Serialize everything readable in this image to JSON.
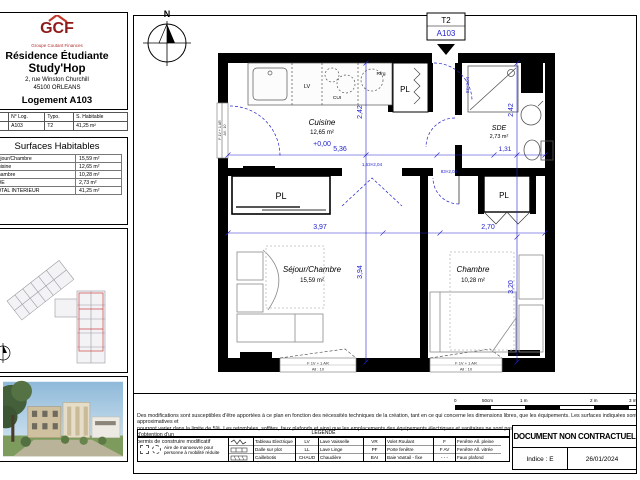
{
  "sheet": {
    "header": {
      "logo_acronym": "GCF",
      "logo_subtitle": "Groupe Coutant Finances",
      "title_line1": "Résidence Étudiante",
      "title_line2": "Study'Hop",
      "address_line1": "2, rue Winston Churchill",
      "address_line2": "45100 ORLEANS",
      "lot_title": "Logement A103"
    },
    "info_table": {
      "headers": [
        "Niv.",
        "N° Log.",
        "Typo.",
        "S. Habitable"
      ],
      "row": [
        "1",
        "A103",
        "T2",
        "41,25 m²"
      ]
    },
    "surfaces": {
      "title": "Surfaces Habitables",
      "rows": [
        {
          "label": "Séjour/Chambre",
          "value": "15,59 m²"
        },
        {
          "label": "Cuisine",
          "value": "12,65 m²"
        },
        {
          "label": "Chambre",
          "value": "10,28 m²"
        },
        {
          "label": "SDE",
          "value": "2,73 m²"
        },
        {
          "label": "TOTAL INTERIEUR",
          "value": "41,25 m²"
        }
      ]
    }
  },
  "plan": {
    "north_label": "N",
    "unit_tag": {
      "type": "T2",
      "number": "A103"
    },
    "rooms": {
      "cuisine": {
        "name": "Cuisine",
        "area": "12,65 m²",
        "level": "+0,00"
      },
      "sde": {
        "name": "SDE",
        "area": "2,73 m²"
      },
      "sejour": {
        "name": "Séjour/Chambre",
        "area": "15,59 m²"
      },
      "chambre": {
        "name": "Chambre",
        "area": "10,28 m²"
      }
    },
    "closet_label": "PL",
    "appliances": {
      "lv": "LV",
      "cui": "CUI",
      "rfrg": "Rfrg"
    },
    "dims": {
      "cuisine_w": "5,36",
      "cuisine_h": "2,42",
      "sde_w": "1,31",
      "sde_h": "2,42",
      "sejour_w": "3,97",
      "sejour_h": "3,94",
      "chambre_w": "2,70",
      "chambre_h": "3,20"
    },
    "door_codes": {
      "entry": "93×2,04",
      "sejour_double": "1,63×2,04",
      "chambre": "83×2,04"
    },
    "window": {
      "code": "F 1V + 1 AR",
      "sill": "All : 10"
    },
    "colors": {
      "dimension_blue": "#2222cc",
      "wall_black": "#000000",
      "logo_red": "#9e1b1b"
    }
  },
  "footer": {
    "disclaimer_line1": "Des modifications sont susceptibles d'être apportées à ce plan en fonction des nécessités techniques de la création, tant en ce qui concerne les dimensions libres, que les équipements. Les surfaces indiquées sont approximatives et",
    "disclaimer_line2": "pourront varier dans la limite de 5%. Les retombées, soffites, faux plafonds et ainsi que les emplacements des équipements électriques et sanitaires ne sont pas tous figurés ou le sont à titre indicatif.  Sous réserve d'obtention d'un",
    "disclaimer_line3": "permis de construire modificatif",
    "scale_bar": {
      "labels": [
        "0",
        "50cm",
        "1 m",
        "2 m",
        "3 m"
      ]
    },
    "legend": {
      "title": "LEGENDE",
      "pmr": "Aire de manoeuvre pour personne à mobilité réduite",
      "symbols": [
        {
          "label": "Tableau Electrique"
        },
        {
          "label": "Dalle sur plot"
        },
        {
          "label": "Caillebotis"
        }
      ],
      "col1": [
        {
          "abbr": "LV",
          "label": "Lave Vaisselle"
        },
        {
          "abbr": "LL",
          "label": "Lave Linge"
        },
        {
          "abbr": "CHAUD",
          "label": "Chaudière"
        }
      ],
      "col2": [
        {
          "abbr": "VR",
          "label": "Volet Roulant"
        },
        {
          "abbr": "PF",
          "label": "Porte fenêtre"
        },
        {
          "abbr": "BAI",
          "label": "Baie Vantail - fixe"
        }
      ],
      "col3": [
        {
          "abbr": "F",
          "label": "Fenêtre All. pleine"
        },
        {
          "abbr": "F AV",
          "label": "Fenêtre All. vitrée"
        },
        {
          "abbr": "- - -",
          "label": "Faux plafond"
        }
      ]
    },
    "doc_box": {
      "title": "DOCUMENT NON CONTRACTUEL",
      "indice": "Indice : E",
      "date": "26/01/2024"
    }
  }
}
